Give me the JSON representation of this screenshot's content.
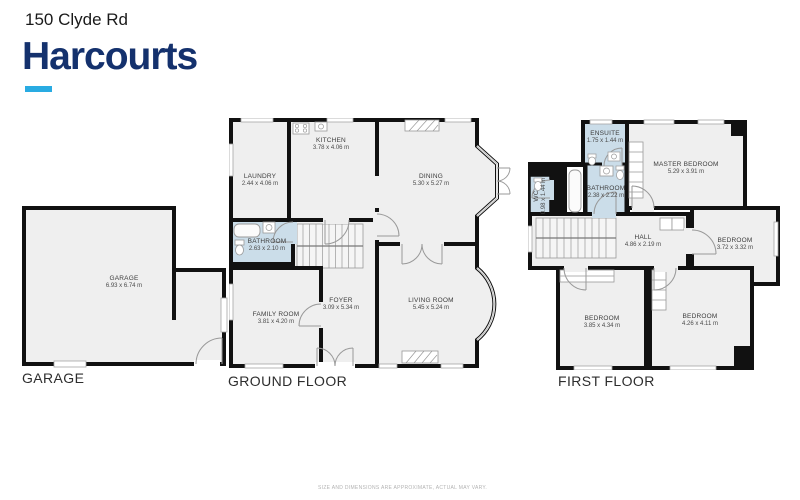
{
  "header": {
    "address": "150 Clyde Rd",
    "brand": "Harcourts"
  },
  "colors": {
    "brand_navy": "#14316d",
    "brand_cyan": "#29abe2",
    "wall": "#111111",
    "room_fill": "#efefef",
    "wet_room_fill": "#cbdde9"
  },
  "plans": {
    "garage": {
      "caption": "GARAGE",
      "rooms": {
        "garage": {
          "name": "GARAGE",
          "dims": "6.93 x 6.74 m"
        }
      }
    },
    "ground": {
      "caption": "GROUND FLOOR",
      "rooms": {
        "laundry": {
          "name": "LAUNDRY",
          "dims": "2.44 x 4.06 m"
        },
        "kitchen": {
          "name": "KITCHEN",
          "dims": "3.78 x 4.06 m"
        },
        "dining": {
          "name": "DINING",
          "dims": "5.30 x 5.27 m"
        },
        "bathroom": {
          "name": "BATHROOM",
          "dims": "2.63 x 2.10 m"
        },
        "family": {
          "name": "FAMILY ROOM",
          "dims": "3.81 x 4.20 m"
        },
        "foyer": {
          "name": "FOYER",
          "dims": "3.09 x 5.34 m"
        },
        "living": {
          "name": "LIVING ROOM",
          "dims": "5.45 x 5.24 m"
        }
      }
    },
    "first": {
      "caption": "FIRST FLOOR",
      "rooms": {
        "ensuite": {
          "name": "ENSUITE",
          "dims": "1.75 x 1.44 m"
        },
        "master": {
          "name": "MASTER BEDROOM",
          "dims": "5.29 x 3.91 m"
        },
        "wc": {
          "name": "WC",
          "dims": "0.98 x 1.44 m"
        },
        "bathroom": {
          "name": "BATHROOM",
          "dims": "2.38 x 2.22 m"
        },
        "hall": {
          "name": "HALL",
          "dims": "4.86 x 2.19 m"
        },
        "bedroom_side": {
          "name": "BEDROOM",
          "dims": "3.72 x 3.32 m"
        },
        "bedroom_left": {
          "name": "BEDROOM",
          "dims": "3.85 x 4.34 m"
        },
        "bedroom_right": {
          "name": "BEDROOM",
          "dims": "4.26 x 4.11 m"
        }
      }
    }
  },
  "footer": {
    "disclaimer": "SIZE AND DIMENSIONS ARE APPROXIMATE, ACTUAL MAY VARY."
  }
}
